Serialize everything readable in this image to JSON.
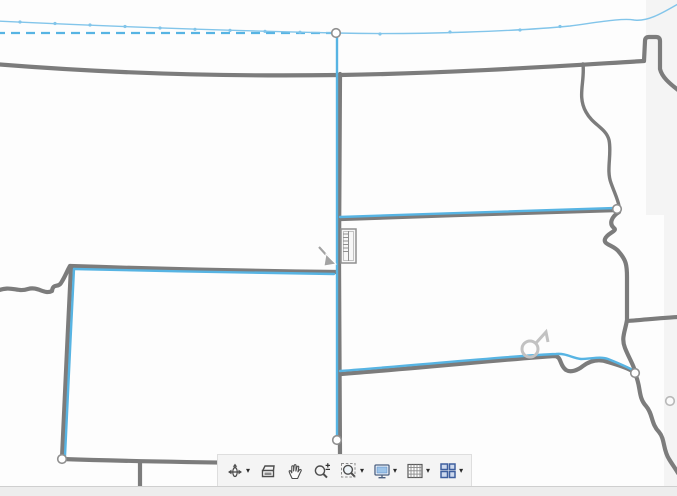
{
  "window": {
    "kind": "map-edit-canvas"
  },
  "colors": {
    "map_bg": "#fdfdfd",
    "boundary_gray": "#7c7c7c",
    "selected_blue": "#57b4e3",
    "guide_blue": "#82c5ea",
    "vertex_stroke": "#8f8f8f",
    "toolbar_bg": "#f4f4f4",
    "strip_bg": "#ededed",
    "frame_band": "#f4f4f4",
    "indicator_gray": "#c2c2c2",
    "cursor_gray": "#a3a3a3"
  },
  "map": {
    "features": [
      {
        "name": "canada-border",
        "kind": "boundary",
        "d": "M -6 64 C 80 71, 200 77, 340 75 C 460 73, 575 65, 644 61 L 645 41 Q 645 37, 649 37 L 656 37 Q 660 37, 660 41 L 660 69 C 662 77, 669 83, 678 90"
      },
      {
        "name": "red-river-border",
        "kind": "boundary-thin",
        "d": "M 583 64 C 585 82, 577 96, 586 112 C 593 125, 606 128, 609 140 C 612 154, 606 170, 611 183 C 615 194, 618 200, 619 206"
      },
      {
        "name": "minnesota-west-border",
        "kind": "boundary",
        "d": "M 619 212 C 611 217, 609 224, 614 228 C 618 231, 607 233, 605 239 C 603 245, 614 245, 619 252 C 626 260, 627 265, 627 277 L 627 320 C 625 332, 621 338, 625 348 C 629 358, 633 364, 635 371"
      },
      {
        "name": "minnesota-iowa-border",
        "kind": "boundary",
        "d": "M 627 321 C 642 320, 660 318, 678 317"
      },
      {
        "name": "missouri-river-border",
        "kind": "boundary",
        "d": "M 636 376 C 641 388, 638 397, 646 406 C 653 414, 651 424, 659 432 C 665 439, 663 450, 669 459 C 672 464, 675 468, 678 473"
      },
      {
        "name": "nd-sd-border",
        "kind": "boundary",
        "d": "M 341 219 C 430 216, 540 212, 618 210"
      },
      {
        "name": "sd-ne-border",
        "kind": "boundary",
        "d": "M 341 374 C 420 368, 520 358, 554 356 C 562 356, 559 365, 566 370 C 571 373, 578 370, 583 366 C 591 360, 600 359, 608 362 C 618 365, 628 368, 634 372"
      },
      {
        "name": "mt-nd-meridian-border",
        "kind": "boundary",
        "d": "M 340 74 L 339 260 L 340 456"
      },
      {
        "name": "mt-wy-border",
        "kind": "boundary",
        "d": "M 70 266 C 160 269, 250 271, 337 272"
      },
      {
        "name": "wy-west-border",
        "kind": "boundary",
        "d": "M 71 267 C 68 330, 64 410, 62 458"
      },
      {
        "name": "id-mt-border",
        "kind": "boundary",
        "d": "M -6 292 C 12 284, 16 293, 28 289 C 38 286, 44 295, 52 291 C 53 283, 58 288, 61 283 C 65 277, 67 271, 70 266"
      },
      {
        "name": "wy-co-south-border",
        "kind": "boundary",
        "d": "M 62 459 C 150 462, 300 464, 458 465"
      },
      {
        "name": "ne-co-vertical-border",
        "kind": "boundary",
        "d": "M 140 463 L 140 488"
      },
      {
        "name": "selected-meridian-line",
        "kind": "selected",
        "d": "M 337 33 L 337 440"
      },
      {
        "name": "sketch-dashed-line",
        "kind": "selected-dashed",
        "d": "M -4 33 L 336 33"
      },
      {
        "name": "selected-nd-sd-line",
        "kind": "selected",
        "d": "M 340 217 C 430 214, 540 210, 616 208"
      },
      {
        "name": "selected-sd-ne-line",
        "kind": "selected",
        "d": "M 340 371 C 420 365, 520 355, 556 354 C 566 353, 572 358, 581 359 C 591 359, 600 356, 608 359 C 618 363, 628 367, 634 371"
      },
      {
        "name": "selected-wy-top-line",
        "kind": "selected",
        "d": "M 74 269 C 160 271, 250 273, 334 274"
      },
      {
        "name": "selected-wy-west-line",
        "kind": "selected",
        "d": "M 74 269 C 71 330, 67 410, 65 456"
      },
      {
        "name": "guide-parallel-west",
        "kind": "guide",
        "d": "M -4 21 C 80 25, 200 30, 336 33"
      },
      {
        "name": "guide-parallel-east",
        "kind": "guide",
        "d": "M 336 33 C 420 35, 520 31, 570 26 C 600 22, 622 18, 634 20 C 648 22, 664 12, 678 4"
      }
    ],
    "guide_vertex_dots": [
      {
        "x": 20,
        "y": 22
      },
      {
        "x": 55,
        "y": 23.5
      },
      {
        "x": 90,
        "y": 25
      },
      {
        "x": 125,
        "y": 26.5
      },
      {
        "x": 160,
        "y": 28
      },
      {
        "x": 195,
        "y": 29.3
      },
      {
        "x": 230,
        "y": 30.4
      },
      {
        "x": 265,
        "y": 31.4
      },
      {
        "x": 300,
        "y": 32.2
      },
      {
        "x": 380,
        "y": 34
      },
      {
        "x": 450,
        "y": 32
      },
      {
        "x": 520,
        "y": 30
      },
      {
        "x": 560,
        "y": 26.5
      }
    ],
    "vertices": [
      {
        "name": "vertex-handle-top",
        "x": 336,
        "y": 33,
        "ghost": false
      },
      {
        "name": "vertex-handle-bottom",
        "x": 337,
        "y": 440,
        "ghost": false
      },
      {
        "name": "vertex-handle-nd-sd-east",
        "x": 617,
        "y": 209,
        "ghost": false
      },
      {
        "name": "vertex-handle-sd-ne-east",
        "x": 635,
        "y": 373,
        "ghost": false
      },
      {
        "name": "vertex-handle-wy-sw",
        "x": 62,
        "y": 459,
        "ghost": false
      },
      {
        "name": "vertex-handle-unselected",
        "x": 670,
        "y": 401,
        "ghost": true
      }
    ]
  },
  "toolbar": {
    "caret_glyph": "▾",
    "items": [
      {
        "name": "navigate-rotate-tool",
        "icon": "navigate",
        "dropdown": true
      },
      {
        "name": "overview-window-tool",
        "icon": "overview",
        "dropdown": false
      },
      {
        "name": "pan-tool",
        "icon": "pan-hand",
        "dropdown": false
      },
      {
        "name": "zoom-in-out-tool",
        "icon": "zoom-inout",
        "dropdown": false
      },
      {
        "name": "zoom-window-tool",
        "icon": "zoom-window",
        "dropdown": true
      },
      {
        "name": "view-display-tool",
        "icon": "display",
        "dropdown": true
      },
      {
        "name": "grid-display-tool",
        "icon": "grid",
        "dropdown": true
      },
      {
        "name": "viewport-layout-tool",
        "icon": "viewports",
        "dropdown": true
      }
    ]
  }
}
